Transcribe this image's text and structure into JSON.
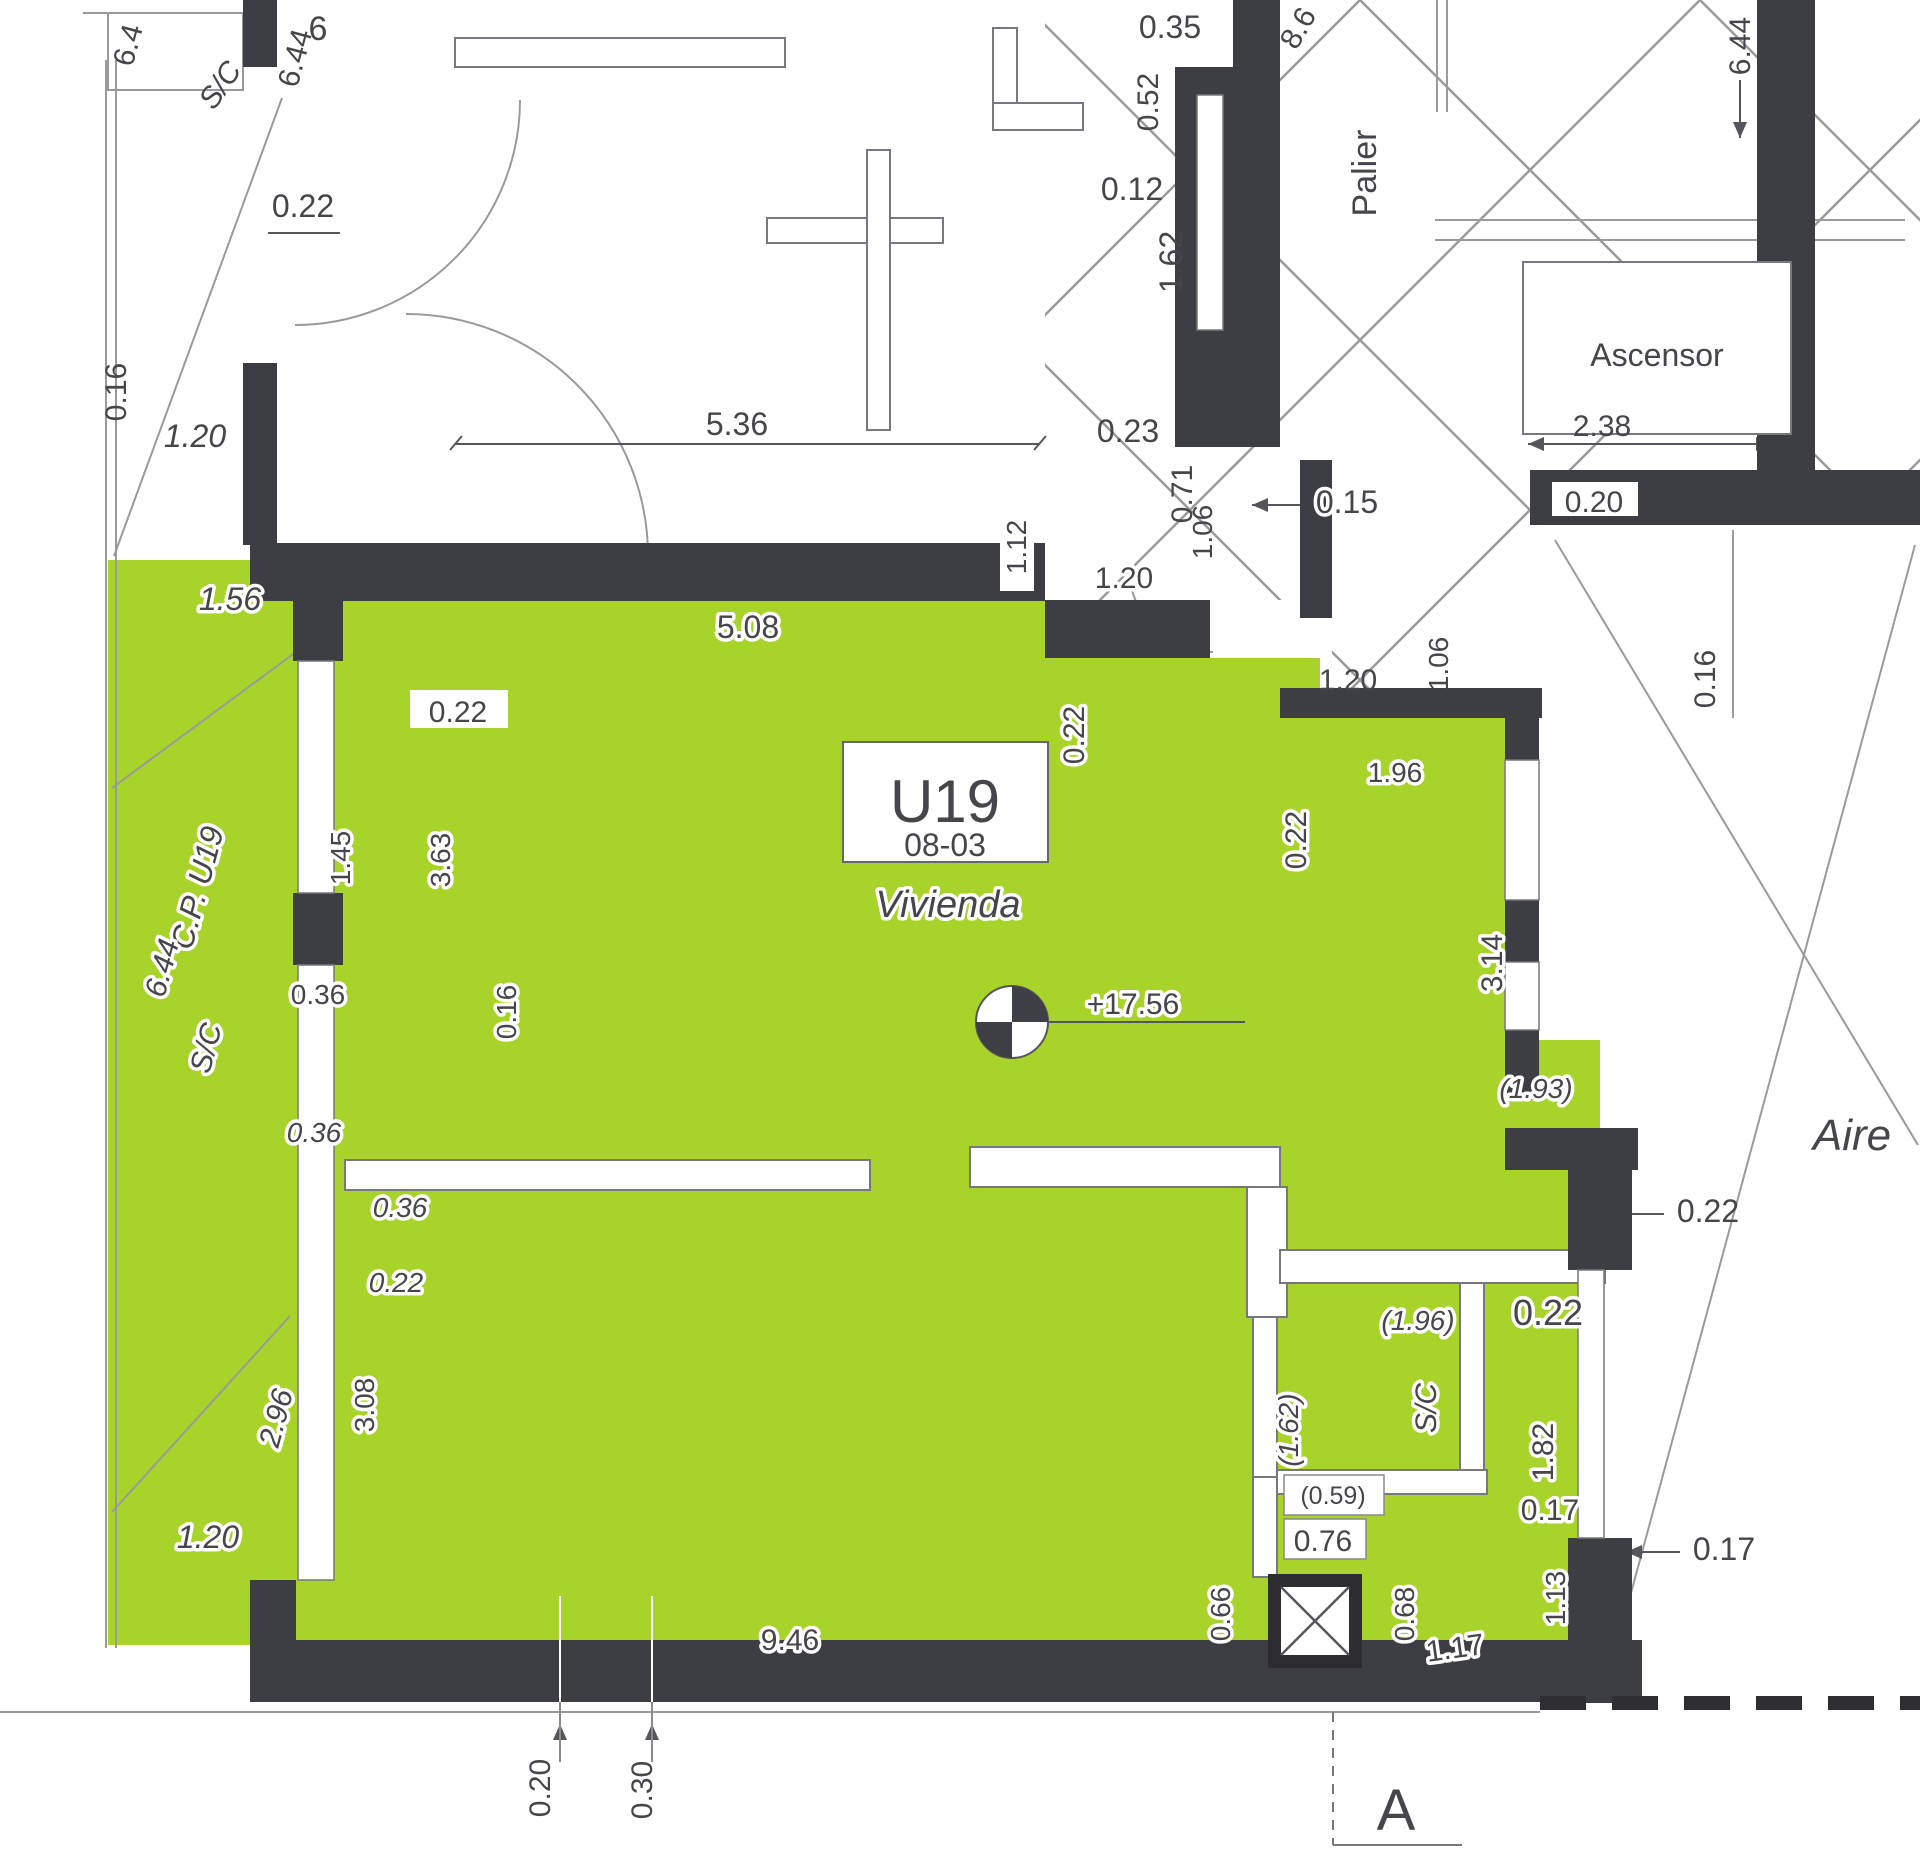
{
  "plan": {
    "unit": {
      "label": "U19",
      "code": "08-03",
      "type": "Vivienda",
      "level_mark": "+17.56"
    },
    "rooms": {
      "palier": "Palier",
      "ascensor": "Ascensor",
      "aire": "Aire",
      "sc_top_left": "S/C",
      "sc_left": "S/C",
      "cp_left": "C.P. U19",
      "sc_bath": "S/C"
    },
    "section": {
      "marker": "A"
    },
    "colors": {
      "unit_fill": "#a8d32a",
      "wall": "#3d3d44",
      "line": "#8a8a8a",
      "text": "#45454b"
    },
    "dims": {
      "t6": "6",
      "tl_644a": "6.4",
      "tl_644b": "6.44",
      "d022_tl": "0.22",
      "d016_l": "0.16",
      "d120_l1": "1.20",
      "d156": "1.56",
      "d536": "5.36",
      "d508": "5.08",
      "d035": "0.35",
      "d052": "0.52",
      "d012": "0.12",
      "d162v": "1.62",
      "d023": "0.23",
      "d071": "0.71",
      "d238": "2.38",
      "d644r": "6.44",
      "d86": "8.6",
      "d015": "0.15",
      "d020r": "0.20",
      "d112": "1.12",
      "d120c1": "1.20",
      "d106a": "1.06",
      "d120c2": "1.20",
      "d106b": "1.06",
      "d016r": "0.16",
      "d022v_entry": "0.22",
      "d196a": "1.96",
      "d022v_neck": "0.22",
      "d314": "3.14",
      "d022_r1": "0.22",
      "d193": "(1.93)",
      "d196b": "(1.96)",
      "d022_r2": "0.22",
      "d162p": "(1.62)",
      "d182": "1.82",
      "d017a": "0.17",
      "d113": "1.13",
      "d117": "1.17",
      "d017b": "0.17",
      "d059": "(0.59)",
      "d076": "0.76",
      "d066": "0.66",
      "d068": "0.68",
      "d644_l": "6.44",
      "d296": "2.96",
      "d120_bl": "1.20",
      "d022_g": "0.22",
      "d145": "1.45",
      "d363": "3.63",
      "d016_m": "0.16",
      "d036a": "0.36",
      "d036b": "0.36",
      "d036c": "0.36",
      "d022_m": "0.22",
      "d308": "3.08",
      "d946": "9.46",
      "d020_b": "0.20",
      "d030_b": "0.30"
    }
  }
}
